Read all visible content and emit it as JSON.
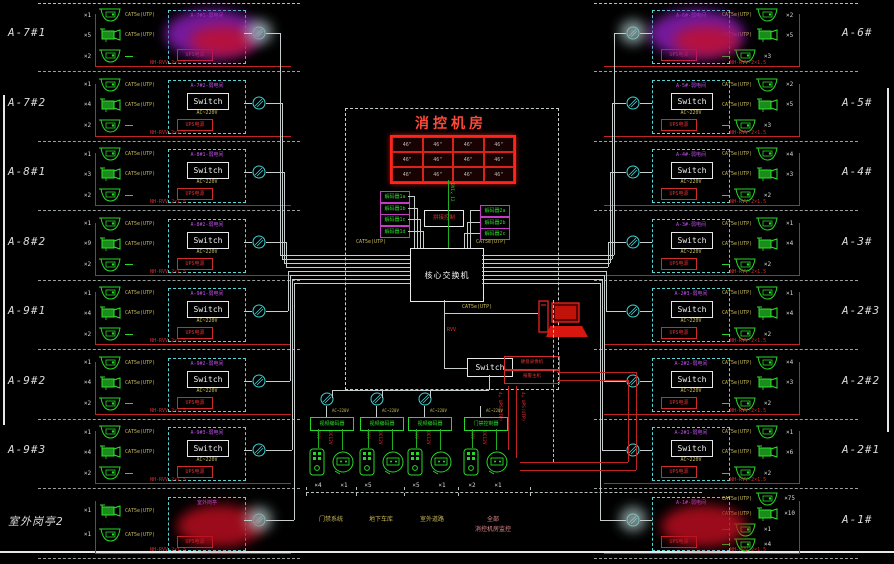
{
  "room": {
    "title": "消控机房",
    "video_wall": {
      "rows": 3,
      "cols": 4,
      "cell_label": "46\""
    },
    "decoders_left": [
      "解码器1a",
      "解码器1b",
      "解码器1c",
      "解码器1d"
    ],
    "decoders_right": [
      "解码器2a",
      "解码器2b",
      "解码器2c"
    ],
    "wall_controller": "拼接控制",
    "dvi_label": "DVI×12",
    "cat5_left": "CAT5e(UTP)",
    "cat5_right": "CAT5e(UTP)",
    "core_switch": "核心交换机",
    "pc_cat5": "CAT5e(UTP)",
    "riser_label": "RVV",
    "sub_switch": "Switch",
    "dvr_boxes": [
      "硬盘录像机",
      "报警主机"
    ],
    "ups_riser": "4×UPS(UTP)"
  },
  "row_common": {
    "switch_label": "Switch",
    "power_label": "AC~220V",
    "ups_label": "UPS电源",
    "feed_label": "NH-RVV-2×1.5",
    "wire_label": "CAT5e(UTP)"
  },
  "left_rows": [
    {
      "label": "A-7#1",
      "title": "A-7#1-弱电间",
      "counts": [
        "×1",
        "×5",
        "×2"
      ],
      "blur": "purple"
    },
    {
      "label": "A-7#2",
      "title": "A-7#2-弱电间",
      "counts": [
        "×1",
        "×4",
        "×2"
      ]
    },
    {
      "label": "A-8#1",
      "title": "A-8#1-弱电间",
      "counts": [
        "×1",
        "×3",
        "×2"
      ]
    },
    {
      "label": "A-8#2",
      "title": "A-8#2-弱电间",
      "counts": [
        "×1",
        "×9",
        "×2"
      ]
    },
    {
      "label": "A-9#1",
      "title": "A-9#1-弱电间",
      "counts": [
        "×1",
        "×4",
        "×2"
      ]
    },
    {
      "label": "A-9#2",
      "title": "A-9#2-弱电间",
      "counts": [
        "×1",
        "×4",
        "×2"
      ]
    },
    {
      "label": "A-9#3",
      "title": "A-9#3-弱电间",
      "counts": [
        "×1",
        "×4",
        "×2"
      ]
    },
    {
      "label": "室外岗亭2",
      "title": "室外岗亭",
      "counts": [
        "×1",
        "×1"
      ],
      "blur": "red"
    }
  ],
  "right_rows": [
    {
      "label": "A-6#",
      "title": "A-6#-弱电间",
      "counts": [
        "×2",
        "×5",
        "×3"
      ],
      "blur": "purple"
    },
    {
      "label": "A-5#",
      "title": "A-5#-弱电间",
      "counts": [
        "×2",
        "×5",
        "×3"
      ]
    },
    {
      "label": "A-4#",
      "title": "A-4#-弱电间",
      "counts": [
        "×4",
        "×3",
        "×2"
      ]
    },
    {
      "label": "A-3#",
      "title": "A-3#-弱电间",
      "counts": [
        "×1",
        "×4",
        "×2"
      ]
    },
    {
      "label": "A-2#3",
      "title": "A-2#3-弱电间",
      "counts": [
        "×1",
        "×4",
        "×2"
      ]
    },
    {
      "label": "A-2#2",
      "title": "A-2#2-弱电间",
      "counts": [
        "×4",
        "×3",
        "×2"
      ]
    },
    {
      "label": "A-2#1",
      "title": "A-2#1-弱电间",
      "counts": [
        "×1",
        "×6",
        "×2"
      ]
    },
    {
      "label": "A-1#",
      "title": "A-1#-弱电间",
      "counts": [
        "×75",
        "×10",
        "×1",
        "×4"
      ],
      "blur": "red"
    }
  ],
  "groups": [
    {
      "device": "视频编码器",
      "ac": "AC~220V",
      "wire1": "RVV",
      "wire2": "DC12V",
      "counts": [
        "×4",
        "×1"
      ],
      "labels": [
        "门禁系统"
      ],
      "accent": "yellow",
      "has_node": true
    },
    {
      "device": "视频编码器",
      "ac": "AC~220V",
      "wire1": "RVV",
      "wire2": "DC12V",
      "counts": [
        "×5",
        ""
      ],
      "labels": [
        "地下车库"
      ],
      "accent": "yellow",
      "has_node": true
    },
    {
      "device": "视频编码器",
      "ac": "AC~220V",
      "wire1": "RVV",
      "wire2": "DC12V",
      "counts": [
        "×5",
        "×1"
      ],
      "labels": [
        "室外道路"
      ],
      "accent": "yellow",
      "has_node": true
    },
    {
      "device": "门禁控制器",
      "ac": "AC~220V",
      "wire1": "RVV",
      "wire2": "DC12V",
      "counts": [
        "×2",
        "×1"
      ],
      "labels": [
        "全部",
        "消控机房监控"
      ],
      "accent": "pink",
      "has_node": false
    }
  ]
}
